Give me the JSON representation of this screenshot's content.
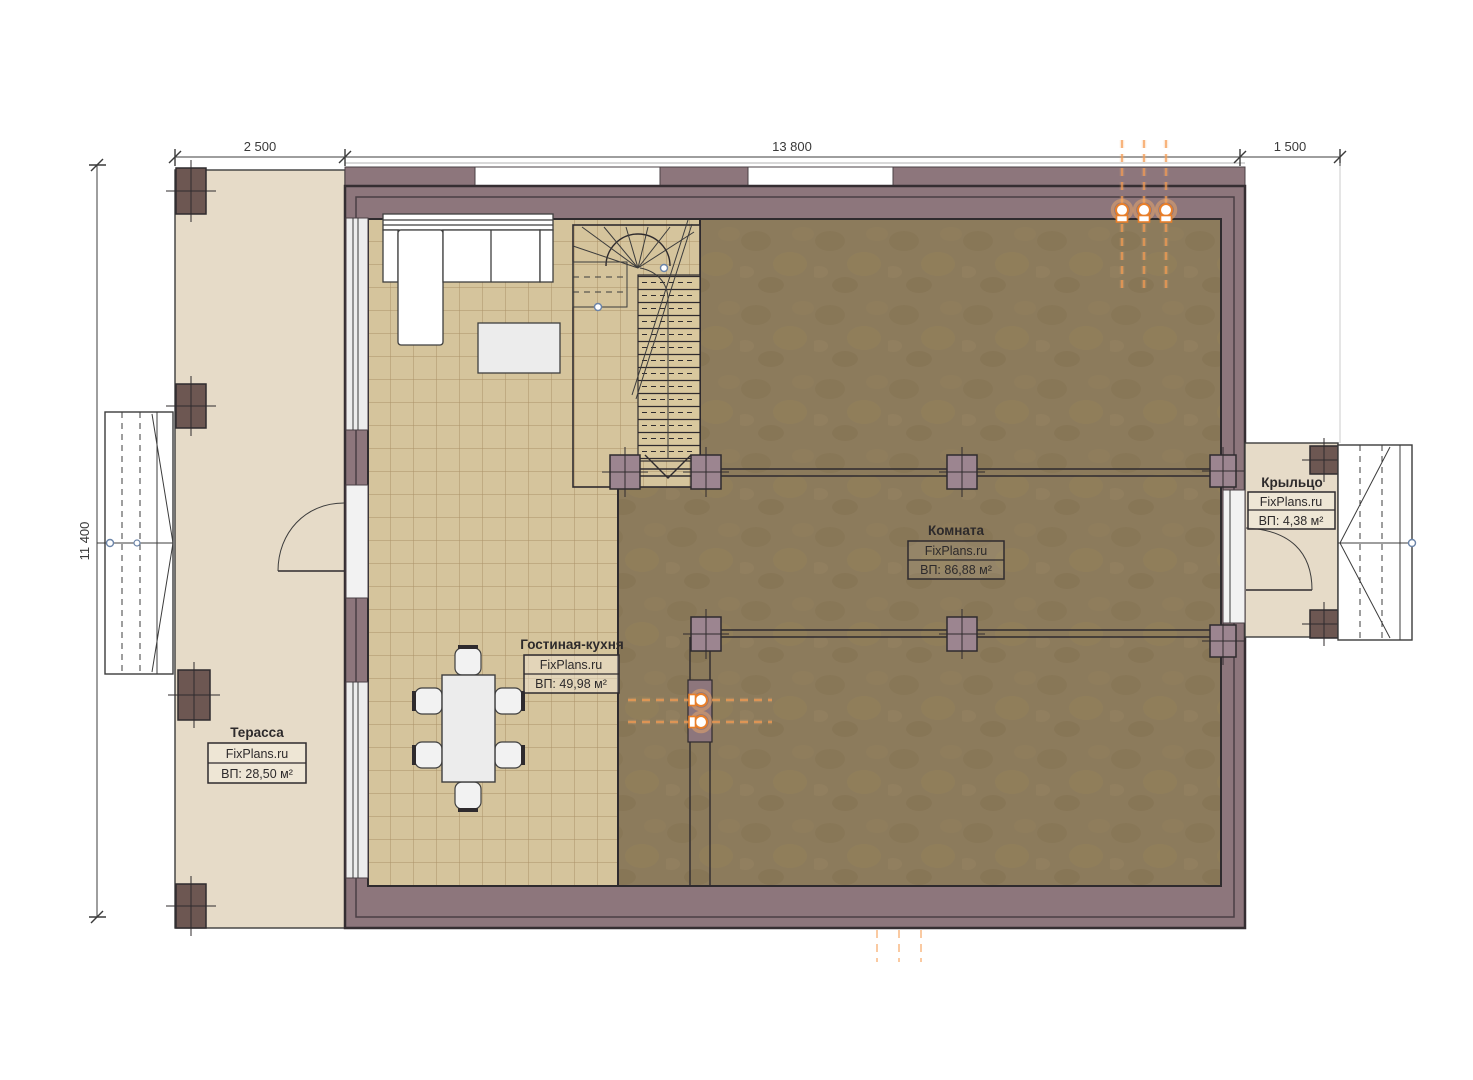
{
  "plan_title": "floor-plan",
  "dimensions": {
    "top": [
      {
        "label": "2 500"
      },
      {
        "label": "13 800"
      },
      {
        "label": "1 500"
      }
    ],
    "left_outer": {
      "label": "11 400"
    },
    "left_inner": {
      "label": "11 400"
    }
  },
  "rooms": {
    "terrace": {
      "name": "Терасса",
      "brand": "FixPlans.ru",
      "area": "ВП: 28,50 м²"
    },
    "living_kitchen": {
      "name": "Гостиная-кухня",
      "brand": "FixPlans.ru",
      "area": "ВП: 49,98 м²"
    },
    "room": {
      "name": "Комната",
      "brand": "FixPlans.ru",
      "area": "ВП: 86,88 м²"
    },
    "porch": {
      "name": "Крыльцо",
      "brand": "FixPlans.ru",
      "area": "ВП: 4,38 м²"
    }
  },
  "colors": {
    "wall": "#8d767c",
    "terrace_floor": "#e6dbc8",
    "tile_floor": "#d5c49c",
    "tile_grid": "#ab9268",
    "room_floor": "#8c7b5c",
    "post_dark": "#6d5752",
    "post_interior": "#9c8590",
    "utility_orange": "#f08a30",
    "outline": "#2f2b2e"
  }
}
